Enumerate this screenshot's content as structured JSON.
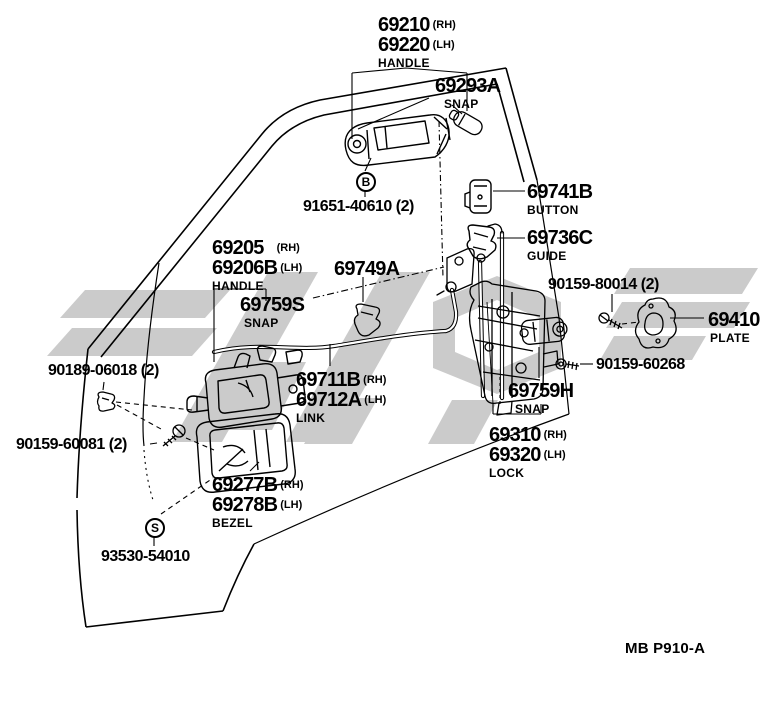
{
  "watermark_color": "#cbcbcb",
  "code": "MB P910-A",
  "markers": {
    "b": "B",
    "s": "S"
  },
  "parts": {
    "handle_outer": {
      "num_rh": "69210",
      "rh": "(RH)",
      "num_lh": "69220",
      "lh": "(LH)",
      "caption": "HANDLE"
    },
    "snap_69293a": {
      "num": "69293A",
      "caption": "SNAP"
    },
    "bolt_91651": {
      "num": "91651-40610 (2)"
    },
    "button_69741b": {
      "num": "69741B",
      "caption": "BUTTON"
    },
    "guide_69736c": {
      "num": "69736C",
      "caption": "GUIDE"
    },
    "handle_inner": {
      "num_rh": "69205",
      "rh": "(RH)",
      "num_lh": "69206B",
      "lh": "(LH)",
      "caption": "HANDLE"
    },
    "snap_69749a": {
      "num": "69749A"
    },
    "snap_69759s": {
      "num": "69759S",
      "caption": "SNAP"
    },
    "screw_90159_80014": {
      "num": "90159-80014 (2)"
    },
    "plate_69410": {
      "num": "69410",
      "caption": "PLATE"
    },
    "clip_90189_06018": {
      "num": "90189-06018 (2)"
    },
    "screw_90159_60268": {
      "num": "90159-60268"
    },
    "link": {
      "num_rh": "69711B",
      "rh": "(RH)",
      "num_lh": "69712A",
      "lh": "(LH)",
      "caption": "LINK"
    },
    "snap_69759h": {
      "num": "69759H",
      "caption": "SNAP"
    },
    "screw_90159_60081": {
      "num": "90159-60081 (2)"
    },
    "lock": {
      "num_rh": "69310",
      "rh": "(RH)",
      "num_lh": "69320",
      "lh": "(LH)",
      "caption": "LOCK"
    },
    "bezel": {
      "num_rh": "69277B",
      "rh": "(RH)",
      "num_lh": "69278B",
      "lh": "(LH)",
      "caption": "BEZEL"
    },
    "screw_93530_54010": {
      "num": "93530-54010"
    }
  }
}
